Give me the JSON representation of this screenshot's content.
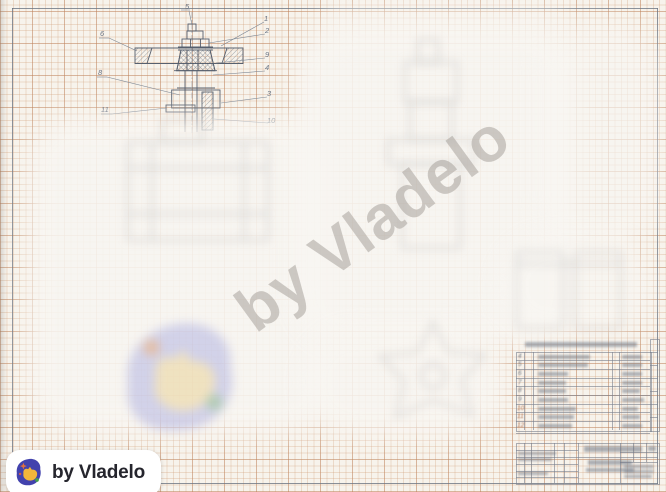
{
  "watermark": {
    "text": "by Vladelo"
  },
  "logo": {
    "text": "by Vladelo"
  },
  "drawing": {
    "type": "hand-drawn valve handwheel assembly cross-section on millimeter graph paper",
    "callouts": [
      "5",
      "1",
      "2",
      "9",
      "4",
      "3",
      "10",
      "6",
      "8",
      "11"
    ]
  },
  "parts_table": {
    "row_numbers": [
      "4",
      "5",
      "6",
      "7",
      "8",
      "9",
      "10",
      "11",
      "12"
    ]
  },
  "colors": {
    "paper": "#f7f3ec",
    "grid_minor": "#d09c76",
    "grid_major": "#ba7e58",
    "frame": "#6d7683",
    "pencil": "#57606e",
    "watermark": "#a39e97",
    "badge_bg": "#ffffff",
    "badge_text": "#25252d",
    "logo_indigo": "#4242ad",
    "logo_yellow": "#f2b63a",
    "logo_green": "#45a04c",
    "logo_orange": "#e2703d"
  }
}
